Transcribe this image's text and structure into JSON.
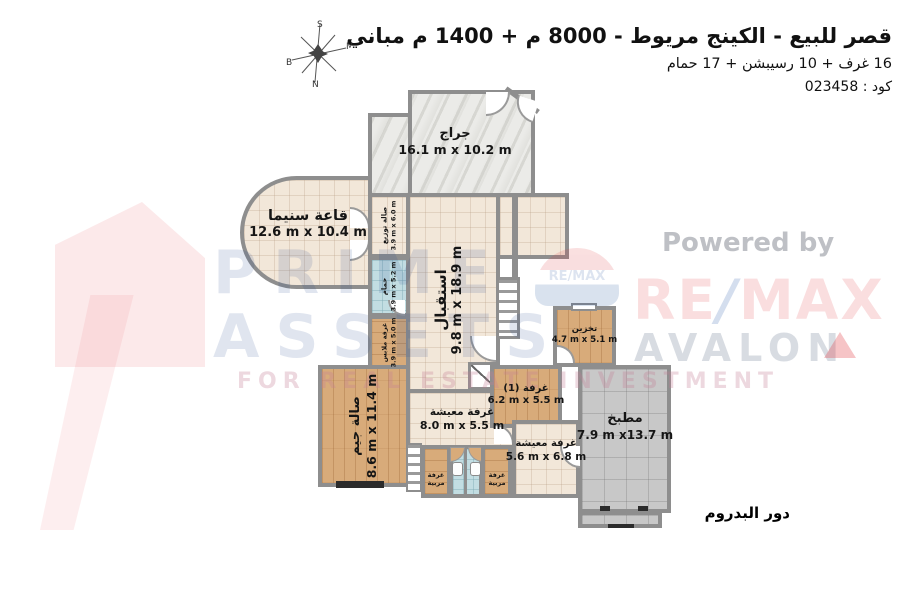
{
  "header": {
    "title": "قصر للبيع - الكينج مريوط - 8000 م + 1400 م مباني",
    "subtitle": "16 غرف + 10 رسيبشن + 17 حمام",
    "code_line": "كود : 023458"
  },
  "compass": {
    "top": "S",
    "bottom": "N",
    "left": "B",
    "right": "M"
  },
  "floor_label": "دور البدروم",
  "watermarks": {
    "prime_line1": "PRIME",
    "prime_line2": "ASSETS",
    "prime_tagline": "FOR REAL ESTATE INVESTMENT",
    "powered_by": "Powered by",
    "remax_re": "RE",
    "remax_slash": "/",
    "remax_max": "MAX",
    "avalon": "AVALON",
    "balloon_text": "RE/MAX"
  },
  "rooms": {
    "garage": {
      "name": "جراج",
      "dims": "16.1 m x 10.2 m"
    },
    "cinema": {
      "name": "قاعة سنيما",
      "dims": "12.6 m x 10.4 m"
    },
    "dist_hall": {
      "name": "صالة توزيع",
      "dims": "3.9 m x 6.0 m"
    },
    "bathroom": {
      "name": "حمام",
      "dims": "3.9 m x 5.2 m"
    },
    "dressing": {
      "name": "غرفة ملابس",
      "dims": "3.9 m x 5.0 m"
    },
    "reception": {
      "name": "استقبال",
      "dims": "9.8 m x 18.9 m"
    },
    "gym": {
      "name": "صالة جيم",
      "dims": "8.6 m x 11.4 m"
    },
    "living1": {
      "name": "غرفة معيشة",
      "dims": "8.0 m x 5.5 m"
    },
    "room1": {
      "name": "غرفة (1)",
      "dims": "6.2 m x 5.5 m"
    },
    "living2": {
      "name": "غرفة معيشة",
      "dims": "5.6 m x 6.8 m"
    },
    "storage": {
      "name": "تخزين",
      "dims": "4.7 m x 5.1 m"
    },
    "kitchen": {
      "name": "مطبخ",
      "dims": "7.9 m x13.7 m"
    },
    "nanny_left": {
      "name": "غرفة مربية"
    },
    "nanny_right": {
      "name": "غرفة مربية"
    }
  },
  "colors": {
    "wall": "#8E8E8E",
    "remax_red": "#E03A3F",
    "remax_blue": "#1D4F9C",
    "prime_blue": "#2D5096",
    "floor_beige": "#F2E7D9",
    "floor_wood": "#D8AB7A",
    "floor_blue": "#C2DDE2",
    "floor_gray": "#C8C8C8"
  }
}
